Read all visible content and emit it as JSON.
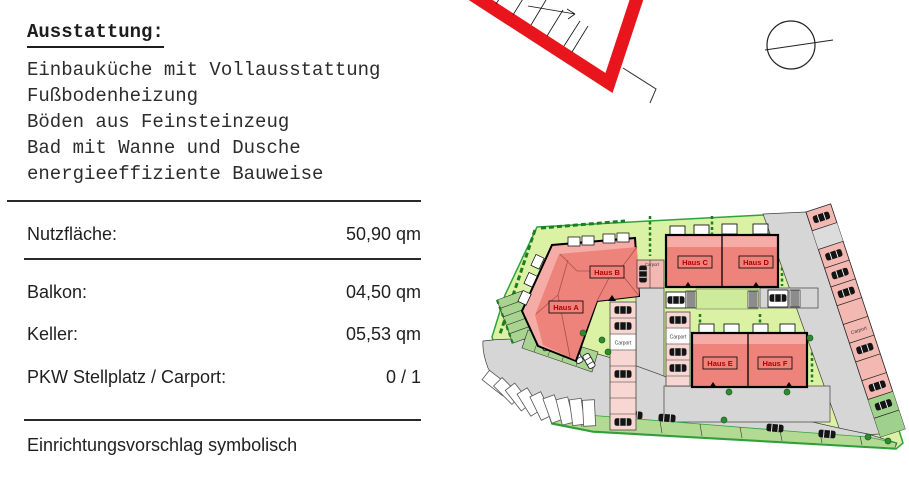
{
  "panel": {
    "title": "Ausstattung:",
    "features": [
      "Einbauküche mit Vollausstattung",
      "Fußbodenheizung",
      "Böden aus Feinsteinzeug",
      "Bad mit Wanne und Dusche",
      "energieeffiziente Bauweise"
    ],
    "specs": [
      {
        "label": "Nutzfläche:",
        "value": "50,90 qm"
      },
      {
        "label": "Balkon:",
        "value": "04,50 qm"
      },
      {
        "label": "Keller:",
        "value": "05,53 qm"
      },
      {
        "label": "PKW Stellplatz / Carport:",
        "value": "0 / 1"
      }
    ],
    "footnote": "Einrichtungsvorschlag symbolisch"
  },
  "site_plan": {
    "houses": [
      {
        "id": "haus-a",
        "label": "Haus A"
      },
      {
        "id": "haus-b",
        "label": "Haus B"
      },
      {
        "id": "haus-c",
        "label": "Haus C"
      },
      {
        "id": "haus-d",
        "label": "Haus D"
      },
      {
        "id": "haus-e",
        "label": "Haus E"
      },
      {
        "id": "haus-f",
        "label": "Haus F"
      }
    ],
    "carports": {
      "near_haus_b": "Carport",
      "column_left": "Carport",
      "column_middle": "Carport",
      "strip_right": "Carport"
    },
    "colors": {
      "building": "#ee837b",
      "building_light": "#f5aca6",
      "parking_pink": "#f4b8b2",
      "site_green": "#dbf2a4",
      "stall_green": "#a8d48f",
      "road_gray": "#d6d6d6",
      "boundary_green": "#2fa33b",
      "outline_red": "#e8151d",
      "label_red": "#b00000"
    }
  }
}
